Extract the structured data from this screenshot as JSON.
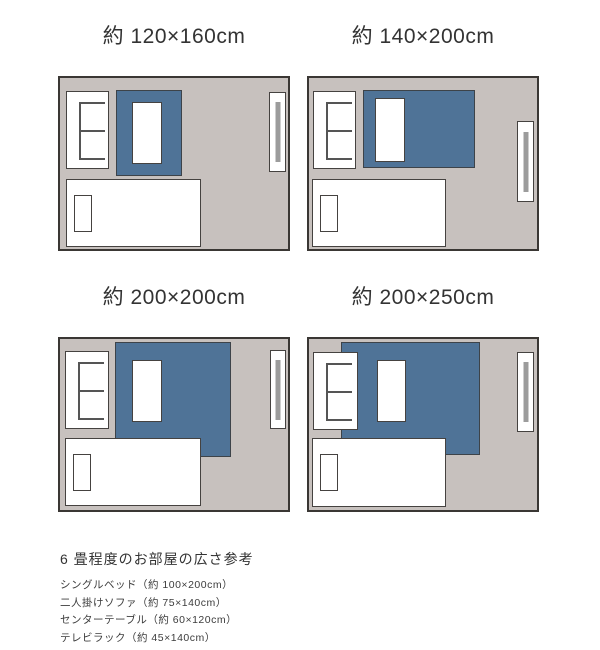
{
  "colors": {
    "page_bg": "#ffffff",
    "room_bg": "#c7c1be",
    "room_border": "#3a3734",
    "furniture_border": "#454240",
    "furniture_fill": "#ffffff",
    "rug_fill": "#4f7397",
    "rug_border": "#3d4349",
    "sofa_line": "#555555",
    "tv_bar": "#9c9c9c",
    "title_text": "#333333",
    "footer_text": "#3c3c3c"
  },
  "panels": [
    {
      "title": "約 120×160cm"
    },
    {
      "title": "約 140×200cm"
    },
    {
      "title": "約 200×200cm"
    },
    {
      "title": "約 200×250cm"
    }
  ],
  "icons": {
    "rug": "blue-rectangle",
    "two-seater-sofa": "white-rect-with-E-cushion-lines",
    "center-table": "white-rectangle-on-rug",
    "single-bed": "white-rectangle-with-pillow",
    "pillow": "small-white-rectangle",
    "tv-rack": "white-vertical-rectangle",
    "tv-screen": "gray-vertical-bar"
  },
  "footer": {
    "heading": "6 畳程度のお部屋の広さ参考",
    "items": [
      "シングルベッド（約 100×200cm）",
      "二人掛けソファ（約 75×140cm）",
      "センターテーブル（約 60×120cm）",
      "テレビラック（約 45×140cm）"
    ]
  }
}
